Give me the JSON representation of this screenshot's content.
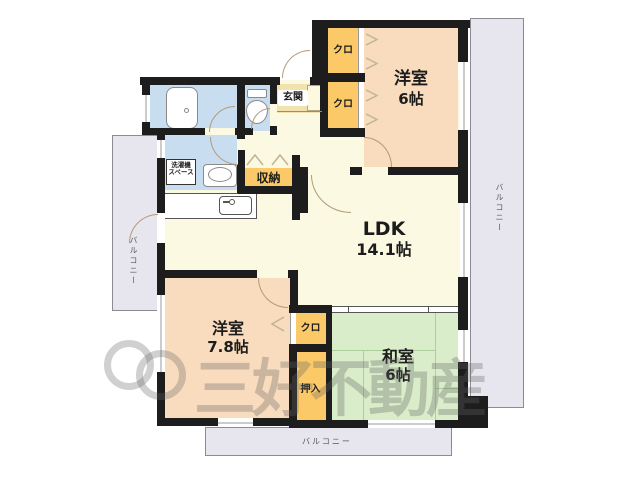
{
  "plan": {
    "type": "apartment-floorplan",
    "rooms": {
      "western6": {
        "name": "洋室",
        "size": "6帖"
      },
      "ldk": {
        "name": "LDK",
        "size": "14.1帖"
      },
      "western78": {
        "name": "洋室",
        "size": "7.8帖"
      },
      "japanese6": {
        "name": "和室",
        "size": "6帖"
      }
    },
    "labels": {
      "genkan": "玄関",
      "closet": "クロ",
      "storage": "収納",
      "oshiire": "押入",
      "laundry_line1": "洗濯機",
      "laundry_line2": "スペース",
      "balcony": "バルコニー"
    },
    "fixtures": [
      "bathtub",
      "toilet",
      "washbasin",
      "kitchen-sink",
      "shoe-cabinet"
    ],
    "watermark": {
      "text": "三好不動産"
    },
    "colors": {
      "wall": "#1d1d1d",
      "western_room": "#f9dcbd",
      "japanese_room": "#d9edca",
      "closet": "#fbc968",
      "wet_area": "#c9ddf1",
      "floor": "#fbf9e2",
      "genkan": "#f2e3ae",
      "balcony": "#e7e6ee",
      "tatami_line": "#abd09c"
    }
  }
}
